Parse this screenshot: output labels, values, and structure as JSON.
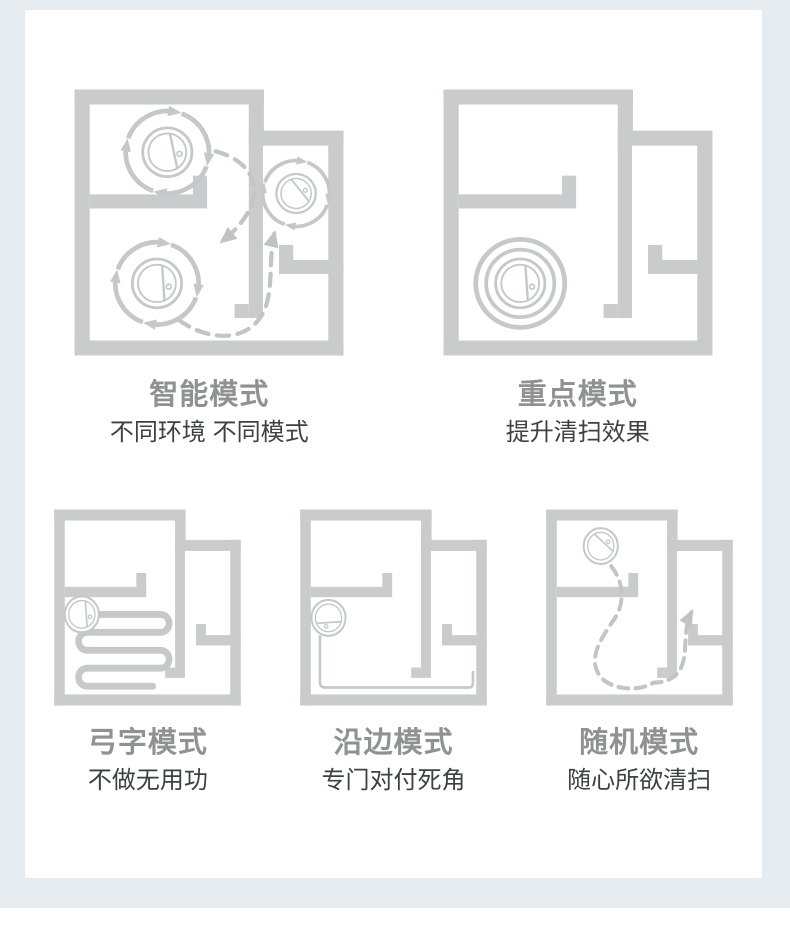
{
  "page": {
    "section_bg": "#e5ebee",
    "card_bg": "#ffffff",
    "footer_bg": "#ffffff"
  },
  "colors": {
    "wall": "#c9cbcc",
    "robot_stroke": "#c5c8c9",
    "route": "#c6c9ca",
    "dashed_path": "#c2c5c6",
    "title_text": "#909192",
    "subtitle_text": "#3e4041"
  },
  "modes": [
    {
      "id": "smart",
      "title": "智能模式",
      "subtitle": "不同环境 不同模式",
      "icon": "floorplan-smart-rotating-robots"
    },
    {
      "id": "spot",
      "title": "重点模式",
      "subtitle": "提升清扫效果",
      "icon": "floorplan-spot-concentric-rings"
    },
    {
      "id": "zigzag",
      "title": "弓字模式",
      "subtitle": "不做无用功",
      "icon": "floorplan-zigzag-route"
    },
    {
      "id": "edge",
      "title": "沿边模式",
      "subtitle": "专门对付死角",
      "icon": "floorplan-edge-route"
    },
    {
      "id": "random",
      "title": "随机模式",
      "subtitle": "随心所欲清扫",
      "icon": "floorplan-random-dashed-route"
    }
  ]
}
